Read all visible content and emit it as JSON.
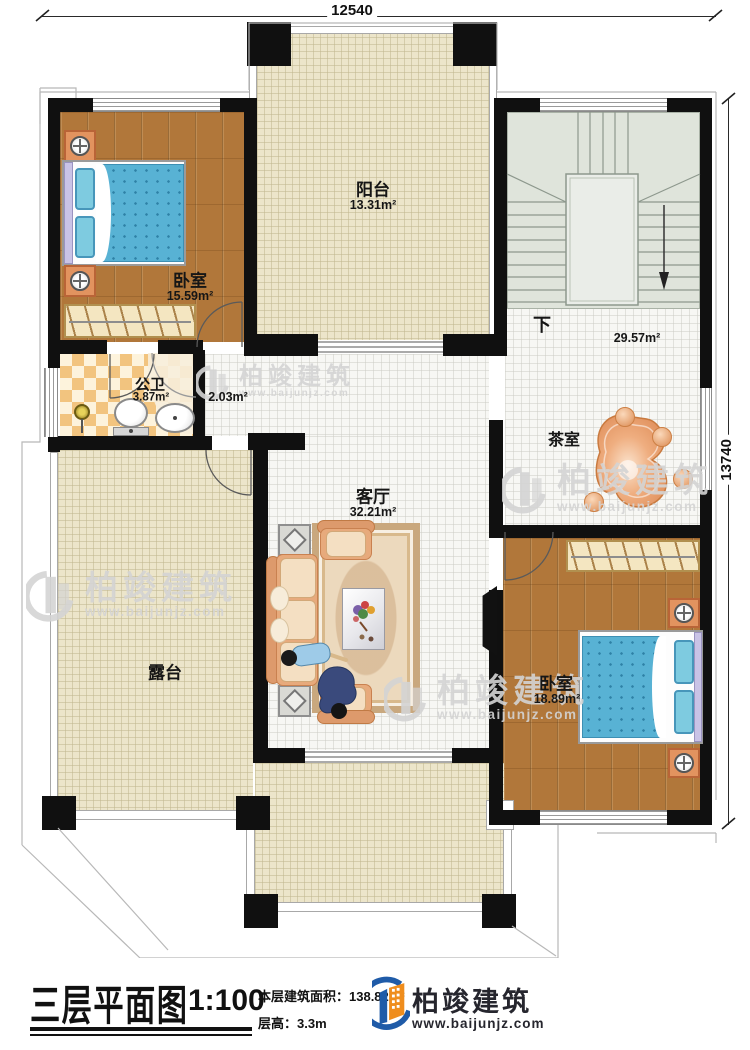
{
  "plan": {
    "dim_top": "12540",
    "dim_right": "13740",
    "rooms": {
      "balcony": {
        "name": "阳台",
        "area": "13.31m²"
      },
      "bedroom1": {
        "name": "卧室",
        "area": "15.59m²"
      },
      "bathroom": {
        "name": "公卫",
        "area": "3.87m²"
      },
      "hallway": {
        "area": "2.03m²"
      },
      "stairwell": {
        "area": "29.57m²",
        "direction": "下"
      },
      "tearoom": {
        "name": "茶室"
      },
      "living": {
        "name": "客厅",
        "area": "32.21m²"
      },
      "terrace": {
        "name": "露台"
      },
      "bedroom2": {
        "name": "卧室",
        "area": "18.89m²"
      }
    }
  },
  "watermark": {
    "brand": "柏竣建筑",
    "url": "www.baijunjz.com"
  },
  "title_block": {
    "title": "三层平面图",
    "scale": "1:100",
    "floor_area": "本层建筑面积：138.82m²",
    "floor_height": "层高：3.3m",
    "brand": "柏竣建筑",
    "brand_url": "www.baijunjz.com"
  },
  "colors": {
    "logo_blue": "#1f5ba8",
    "logo_orange": "#ef8d1d",
    "wall": "#101010"
  }
}
